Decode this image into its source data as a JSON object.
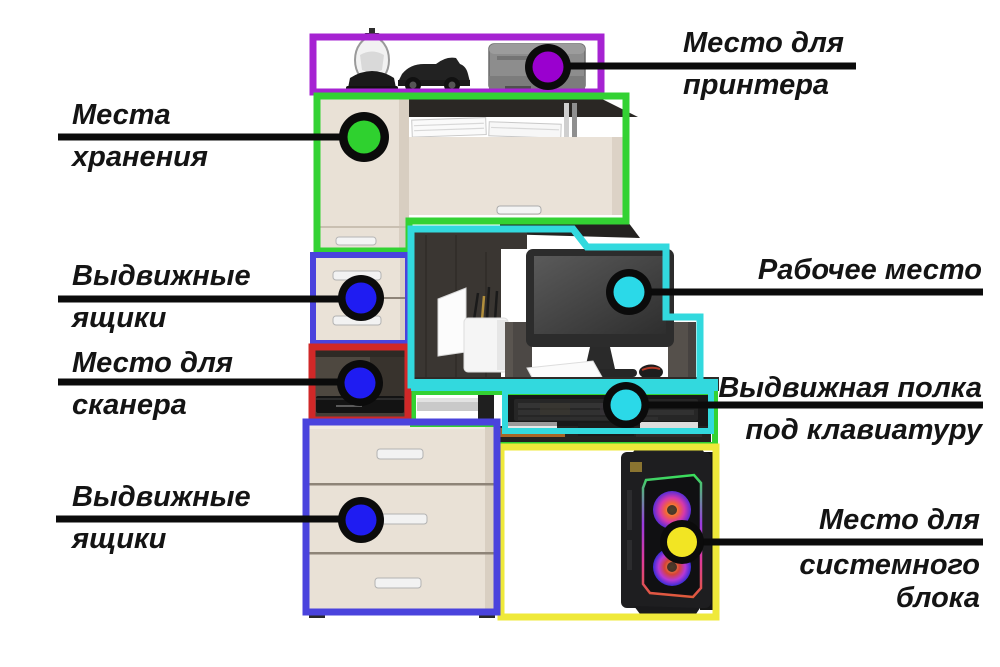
{
  "colors": {
    "leader-line": "#0b0b0b",
    "label-text": "#141414",
    "zone-purple": "#a623d2",
    "zone-green": "#33d233",
    "zone-blue": "#4a43dd",
    "zone-red": "#d02828",
    "zone-cyan": "#32d9de",
    "zone-yellow": "#efe93a",
    "marker-purple": "#9a00cf",
    "marker-green": "#2fd12f",
    "marker-blue": "#1f1cf2",
    "marker-cyan": "#2bd9e8",
    "marker-yellow": "#f2e523"
  },
  "annotations": [
    {
      "id": "printer",
      "lines": [
        "Место для",
        "принтера"
      ],
      "zone_color_key": "zone-purple",
      "marker_color_key": "marker-purple"
    },
    {
      "id": "storage",
      "lines": [
        "Места",
        "хранения"
      ],
      "zone_color_key": "zone-green",
      "marker_color_key": "marker-green"
    },
    {
      "id": "drawers-top",
      "lines": [
        "Выдвижные",
        "ящики"
      ],
      "zone_color_key": "zone-blue",
      "marker_color_key": "marker-blue"
    },
    {
      "id": "scanner",
      "lines": [
        "Место для",
        "сканера"
      ],
      "zone_color_key": "zone-red",
      "marker_color_key": "marker-blue"
    },
    {
      "id": "workspace",
      "lines": [
        "Рабочее место"
      ],
      "zone_color_key": "zone-cyan",
      "marker_color_key": "marker-cyan"
    },
    {
      "id": "keyboard-shelf",
      "lines": [
        "Выдвижная полка",
        "под клавиатуру"
      ],
      "zone_color_key": "zone-cyan",
      "marker_color_key": "marker-cyan"
    },
    {
      "id": "drawers-bottom",
      "lines": [
        "Выдвижные",
        "ящики"
      ],
      "zone_color_key": "zone-blue",
      "marker_color_key": "marker-blue"
    },
    {
      "id": "system-unit",
      "lines": [
        "Место для",
        "системного",
        "блока"
      ],
      "zone_color_key": "zone-yellow",
      "marker_color_key": "marker-yellow"
    }
  ]
}
